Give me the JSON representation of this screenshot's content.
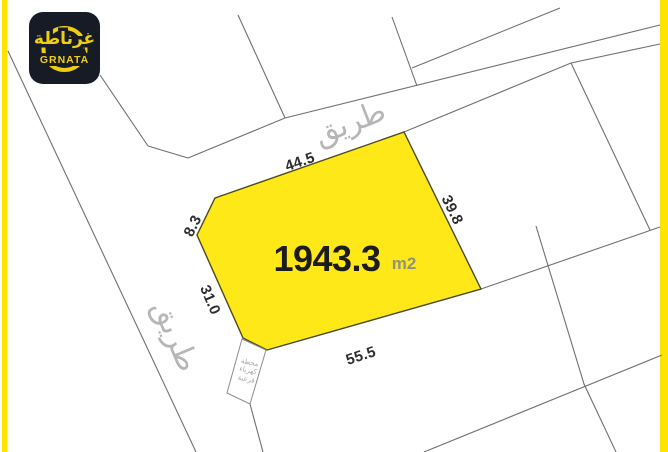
{
  "logo": {
    "arabic": "غرناطة",
    "latin": "GRNATA"
  },
  "plot": {
    "area_value": "1943.3",
    "area_unit": "m2"
  },
  "dimensions": {
    "top": "44.5",
    "top_left": "8.3",
    "right": "39.8",
    "left": "31.0",
    "bottom": "55.5"
  },
  "roads": {
    "top_label": "طريق",
    "left_label": "طريق"
  },
  "substation": {
    "line1": "محطة",
    "line2": "كهرباء",
    "line3": "فرعية"
  },
  "colors": {
    "brand_yellow": "#FFE400",
    "plot_fill": "#FFE818",
    "plot_border": "#4A4A22",
    "logo_bg": "#161B25",
    "logo_yellow": "#EFCE12",
    "parcel_line": "#707070",
    "road_label": "#B6B6B6",
    "dimension_text": "#2D2D2D",
    "area_text": "#1C1C1C",
    "unit_text": "#90927F"
  }
}
